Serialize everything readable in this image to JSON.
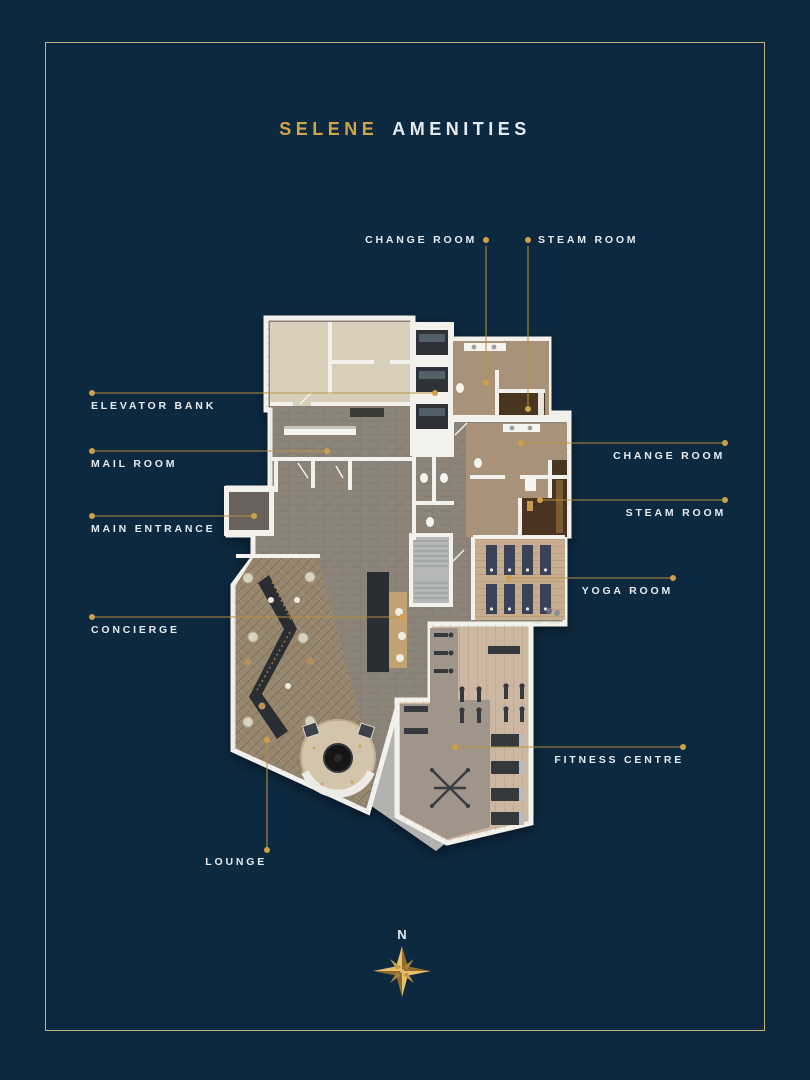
{
  "title": {
    "brand": "SELENE",
    "section": "AMENITIES"
  },
  "labels": {
    "change_room_top": "CHANGE ROOM",
    "steam_room_top": "STEAM ROOM",
    "elevator_bank": "ELEVATOR BANK",
    "mail_room": "MAIL ROOM",
    "main_entrance": "MAIN ENTRANCE",
    "concierge": "CONCIERGE",
    "change_room_right": "CHANGE ROOM",
    "steam_room_right": "STEAM ROOM",
    "yoga_room": "YOGA ROOM",
    "fitness_centre": "FITNESS CENTRE",
    "lounge": "LOUNGE"
  },
  "compass": {
    "north_label": "N"
  },
  "colors": {
    "bg": "#0d2940",
    "frame": "#c6ad7e",
    "gold": "#d2a44a",
    "gold_line": "#b8913f",
    "gold_dot": "#cfa04a",
    "text": "#e6ebef",
    "wall": "#f3f1ec",
    "corridor": "#8c8478",
    "beige": "#d7cfb9",
    "tan": "#a8937a",
    "steam": "#4a3421",
    "yogawood": "#c5ad8d",
    "stairs": "#b5b8b7",
    "loungewood": "#97866e",
    "fitwood": "#ccb7a2",
    "carpet": "#a0958b",
    "equip": "#36393d",
    "desk": "#2b2e33",
    "vestibule": "#6b645c",
    "walkway": "#b2b3b1"
  }
}
